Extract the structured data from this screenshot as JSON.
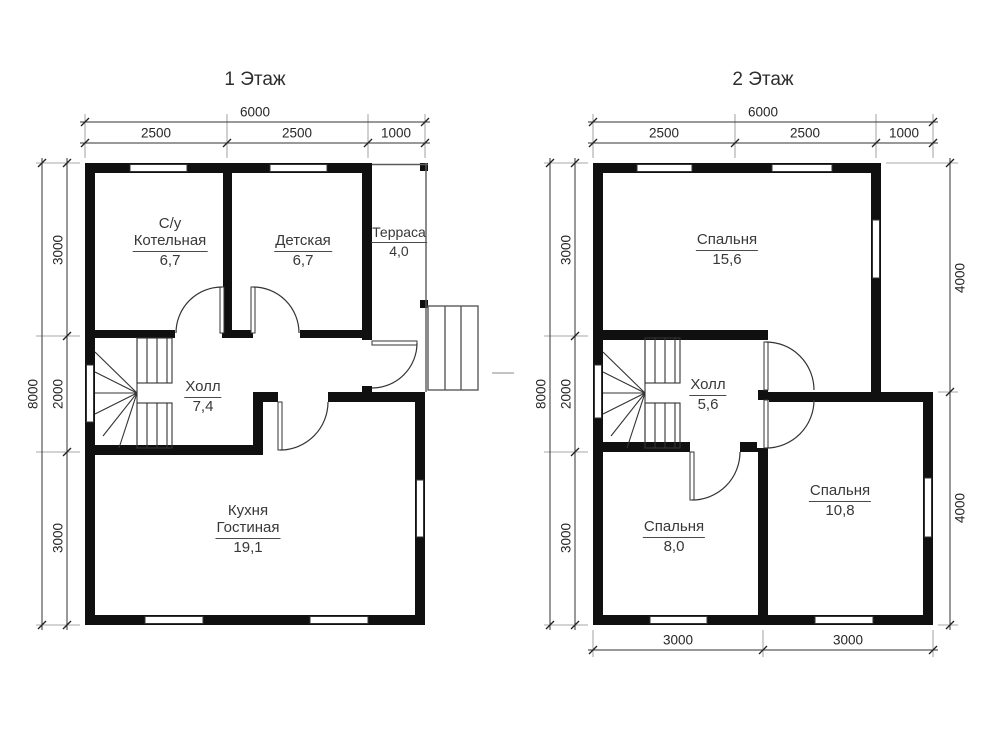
{
  "floor1": {
    "title": "1 Этаж",
    "rooms": {
      "boiler": {
        "line1": "С/у",
        "name": "Котельная",
        "area": "6,7"
      },
      "nursery": {
        "name": "Детская",
        "area": "6,7"
      },
      "terrace": {
        "name": "Терраса",
        "area": "4,0"
      },
      "hall": {
        "name": "Холл",
        "area": "7,4"
      },
      "kitchen": {
        "line1": "Кухня",
        "name": "Гостиная",
        "area": "19,1"
      }
    },
    "dims": {
      "top_total": "6000",
      "top_1": "2500",
      "top_2": "2500",
      "top_3": "1000",
      "left_total": "8000",
      "left_1": "3000",
      "left_2": "2000",
      "left_3": "3000"
    }
  },
  "floor2": {
    "title": "2 Этаж",
    "rooms": {
      "bedroom_large": {
        "name": "Спальня",
        "area": "15,6"
      },
      "hall": {
        "name": "Холл",
        "area": "5,6"
      },
      "bedroom_small": {
        "name": "Спальня",
        "area": "8,0"
      },
      "bedroom_medium": {
        "name": "Спальня",
        "area": "10,8"
      }
    },
    "dims": {
      "top_total": "6000",
      "top_1": "2500",
      "top_2": "2500",
      "top_3": "1000",
      "left_total": "8000",
      "left_1": "3000",
      "left_2": "2000",
      "left_3": "3000",
      "right_1": "4000",
      "right_2": "4000",
      "bottom_1": "3000",
      "bottom_2": "3000"
    }
  }
}
